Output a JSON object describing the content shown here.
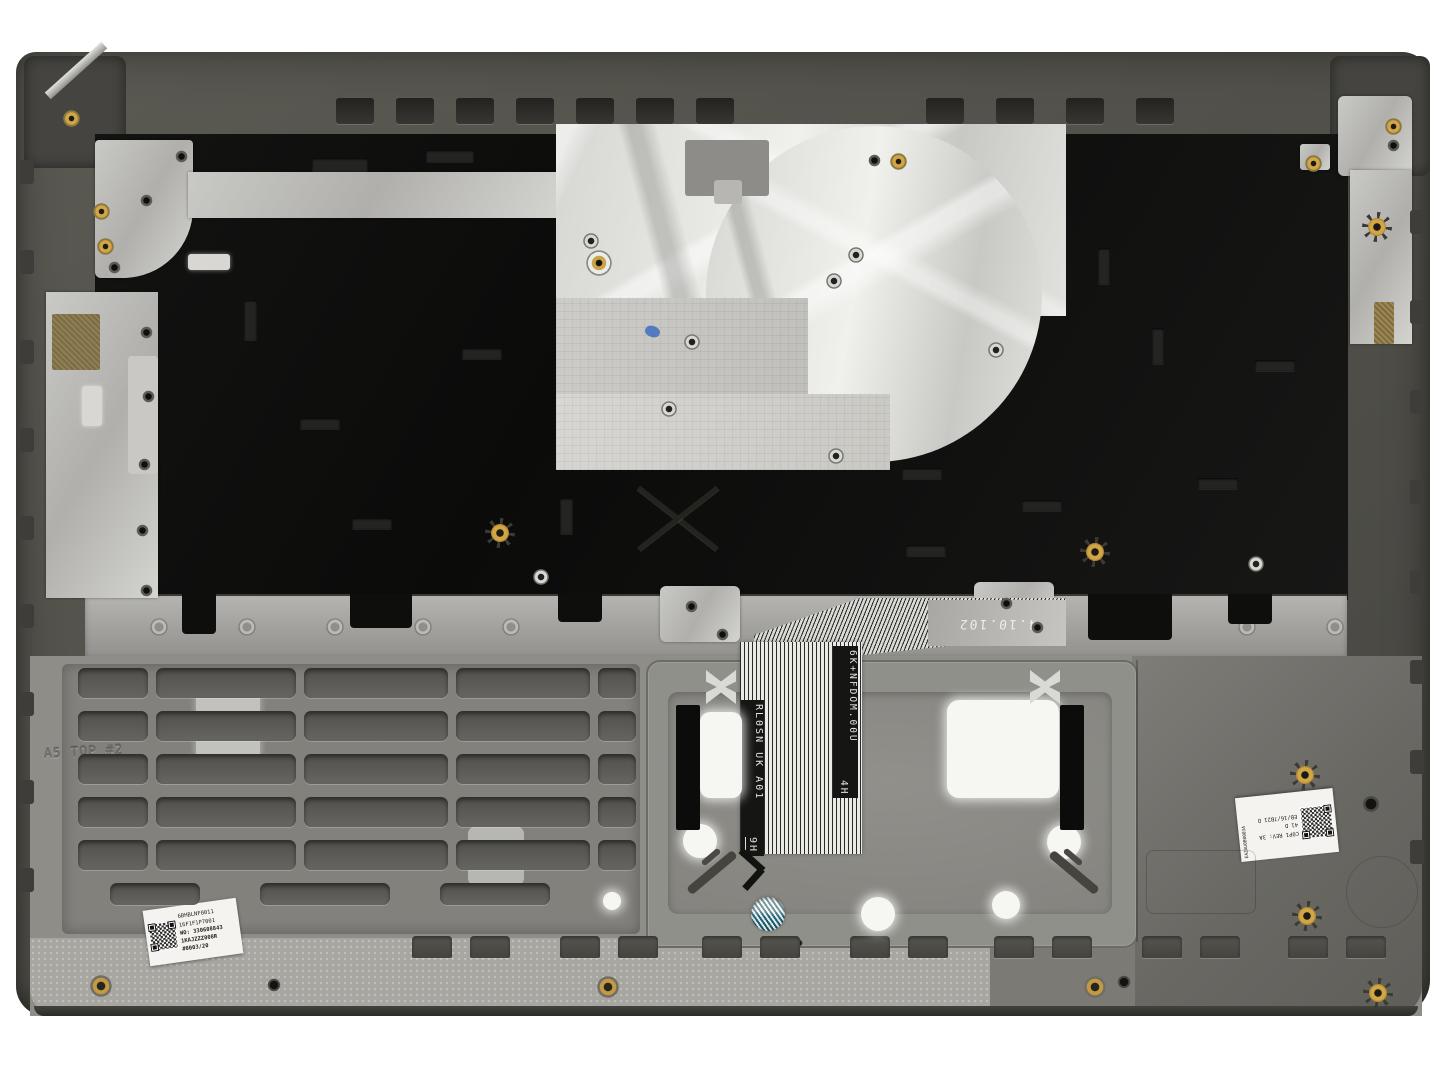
{
  "photo": {
    "subject": "Laptop palmrest top-case assembly, internal underside view",
    "background_color": "#ffffff"
  },
  "chassis": {
    "molded_marking": "A5 TOP #2"
  },
  "keyboard_ribbon": {
    "flex_text_left": "RL0SN UK A01",
    "flex_code_left": "9H",
    "flex_text_right": "6K+NFDOM.00U",
    "flex_code_right": "4H",
    "date_stamp": "4.10.102"
  },
  "labels": {
    "left": {
      "line1": "6BHBLNF0011",
      "line2": "16F1F1P7001",
      "line3": "WO: 330608843",
      "line4": "1KAJZZZ008R",
      "line5": "#0003/20"
    },
    "right": {
      "line1": "C0P1 REV: 3A",
      "line2": "41 D",
      "line3": "EB/16/7B21 D",
      "side": "EAZAU0B0003A"
    }
  },
  "colors": {
    "chassis_gray": "#57564f",
    "backplate_black": "#0d0d0c",
    "foil_silver": "#d9d9d6",
    "copper_pad": "#8a7a52",
    "gold_fastener": "#d2a545",
    "hologram_teal": "#1d6a7d",
    "label_white": "#f4f3ef"
  }
}
